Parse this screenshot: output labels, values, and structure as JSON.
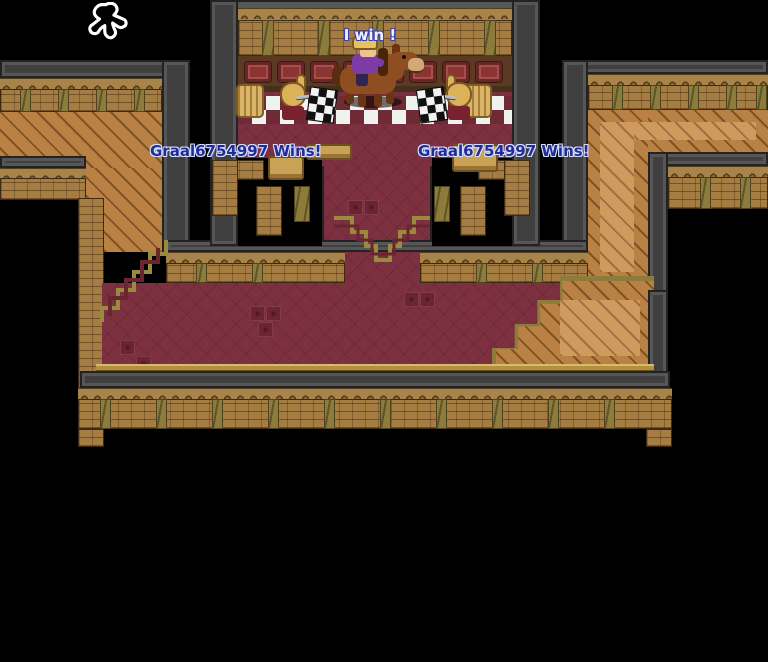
{
  "game": {
    "speech_bubble": "I win !",
    "announcements": {
      "left": "Graal6754997 Wins!",
      "right": "Graal6754997 Wins!"
    },
    "player_name": "Graal6754997"
  },
  "icons": {
    "player_outline": "walking-person-outline-icon",
    "checkered_flag": "checkered-flag-icon",
    "hay_bale": "hay-bale-sprite",
    "horse_rider": "player-riding-horse-sprite"
  },
  "palette": {
    "background": "#000000",
    "wall_gray": "#3f3f3f",
    "brick_tan": "#a57c42",
    "olive_column": "#8c7b3a",
    "plank_wood": "#b98244",
    "carpet_maroon": "#7c3040",
    "checker_light": "#eef3f0",
    "panel_red": "#8c3434",
    "gold_trim": "#b29040",
    "announcement_text_color": "#232d96",
    "bubble_text_color": "#eef1ff"
  }
}
